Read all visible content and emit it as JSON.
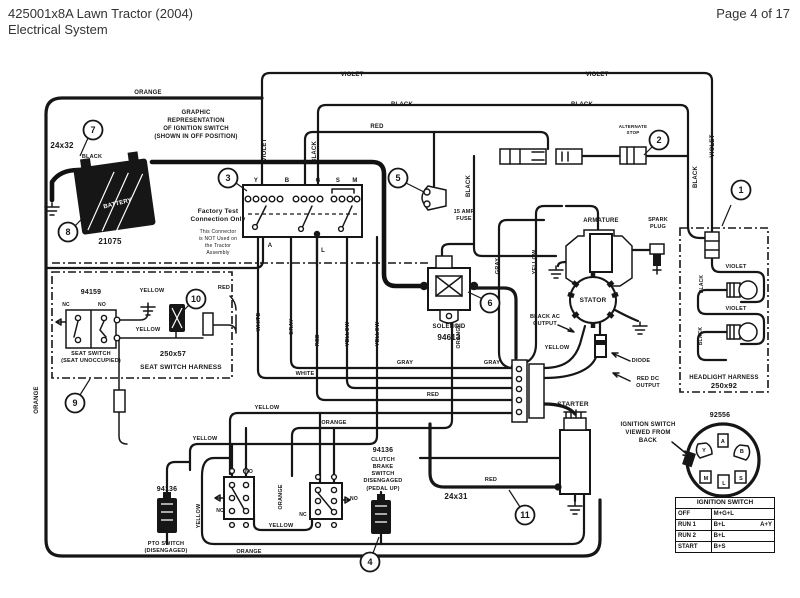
{
  "header": {
    "title_line1": "425001x8A Lawn Tractor (2004)",
    "title_line2": "Electrical System",
    "page_indicator": "Page 4 of 17"
  },
  "diagram": {
    "callouts": [
      {
        "n": "1",
        "x": 741,
        "y": 190,
        "lx": 731,
        "ly": 205,
        "tx": 722,
        "ty": 226
      },
      {
        "n": "2",
        "x": 659,
        "y": 140,
        "lx": 652,
        "ly": 147,
        "tx": 644,
        "ty": 155
      },
      {
        "n": "3",
        "x": 228,
        "y": 178,
        "lx": 236,
        "ly": 183,
        "tx": 247,
        "ty": 191
      },
      {
        "n": "4",
        "x": 370,
        "y": 562,
        "lx": 373,
        "ly": 553,
        "tx": 379,
        "ty": 537
      },
      {
        "n": "5",
        "x": 398,
        "y": 178,
        "lx": 406,
        "ly": 183,
        "tx": 424,
        "ty": 192
      },
      {
        "n": "6",
        "x": 490,
        "y": 303,
        "lx": 483,
        "ly": 299,
        "tx": 468,
        "ty": 292
      },
      {
        "n": "7",
        "x": 93,
        "y": 130,
        "lx": 88,
        "ly": 138,
        "tx": 80,
        "ty": 156
      },
      {
        "n": "8",
        "x": 68,
        "y": 232,
        "lx": 75,
        "ly": 226,
        "tx": 96,
        "ty": 204
      },
      {
        "n": "9",
        "x": 75,
        "y": 403,
        "lx": 80,
        "ly": 395,
        "tx": 90,
        "ty": 379
      },
      {
        "n": "10",
        "x": 196,
        "y": 299,
        "lx": 191,
        "ly": 303,
        "tx": 184,
        "ty": 310
      },
      {
        "n": "11",
        "x": 525,
        "y": 515,
        "lx": 520,
        "ly": 507,
        "tx": 509,
        "ty": 490
      }
    ],
    "labels": [
      {
        "name": "wire-violet-top-left",
        "text": "VIOLET",
        "x": 352,
        "y": 76
      },
      {
        "name": "wire-violet-top-right",
        "text": "VIOLET",
        "x": 597,
        "y": 76
      },
      {
        "name": "wire-black-top-left",
        "text": "BLACK",
        "x": 402,
        "y": 106
      },
      {
        "name": "wire-black-top-right",
        "text": "BLACK",
        "x": 582,
        "y": 106
      },
      {
        "name": "wire-orange-top",
        "text": "ORANGE",
        "x": 148,
        "y": 94
      },
      {
        "name": "wire-red-top",
        "text": "RED",
        "x": 377,
        "y": 128
      },
      {
        "name": "wire-violet-vert",
        "text": "VIOLET",
        "x": 266,
        "y": 150,
        "r": -90
      },
      {
        "name": "wire-black-vert-switch",
        "text": "BLACK",
        "x": 316,
        "y": 152,
        "r": -90
      },
      {
        "name": "wire-black-vert-fuse",
        "text": "BLACK",
        "x": 470,
        "y": 186,
        "r": -90
      },
      {
        "name": "wire-black-vert-head",
        "text": "BLACK",
        "x": 697,
        "y": 177,
        "r": -90
      },
      {
        "name": "wire-violet-vert-head",
        "text": "VIOLET",
        "x": 714,
        "y": 146,
        "r": -90
      },
      {
        "name": "wire-black-battery",
        "text": "BLACK",
        "x": 92,
        "y": 158,
        "s": 5.5
      },
      {
        "name": "wire-white-vert",
        "text": "WHITE",
        "x": 260,
        "y": 322,
        "r": -90,
        "s": 5.5
      },
      {
        "name": "wire-gray-vert",
        "text": "GRAY",
        "x": 293,
        "y": 327,
        "r": -90,
        "s": 5.5
      },
      {
        "name": "wire-red-vert",
        "text": "RED",
        "x": 319,
        "y": 340,
        "r": -90,
        "s": 5.5
      },
      {
        "name": "wire-yellow-vert-1",
        "text": "YELLOW",
        "x": 349,
        "y": 334,
        "r": -90,
        "s": 5.5
      },
      {
        "name": "wire-yellow-vert-2",
        "text": "YELLOW",
        "x": 379,
        "y": 334,
        "r": -90,
        "s": 5.5
      },
      {
        "name": "wire-gray-vert-sol",
        "text": "GRAY",
        "x": 499,
        "y": 266,
        "r": -90,
        "s": 5.5
      },
      {
        "name": "wire-yellow-vert-sol",
        "text": "YELLOW",
        "x": 536,
        "y": 262,
        "r": -90,
        "s": 5.5
      },
      {
        "name": "wire-orange-vert-sol",
        "text": "ORANGE",
        "x": 460,
        "y": 336,
        "r": -90,
        "s": 5.5
      },
      {
        "name": "wire-gray-row-1",
        "text": "GRAY",
        "x": 405,
        "y": 364,
        "s": 5.5
      },
      {
        "name": "wire-gray-row-2",
        "text": "GRAY",
        "x": 492,
        "y": 364,
        "s": 5.5
      },
      {
        "name": "wire-white-row",
        "text": "WHITE",
        "x": 305,
        "y": 375,
        "s": 5.5
      },
      {
        "name": "wire-red-row",
        "text": "RED",
        "x": 433,
        "y": 396,
        "s": 5.5
      },
      {
        "name": "wire-yellow-stator",
        "text": "YELLOW",
        "x": 557,
        "y": 349,
        "s": 5.5
      },
      {
        "name": "wire-orange-left",
        "text": "ORANGE",
        "x": 38,
        "y": 400,
        "r": -90
      },
      {
        "name": "wire-yellow-seat-1",
        "text": "YELLOW",
        "x": 152,
        "y": 292,
        "s": 5.5
      },
      {
        "name": "wire-yellow-seat-2",
        "text": "YELLOW",
        "x": 148,
        "y": 331,
        "s": 5.5
      },
      {
        "name": "wire-red-seat",
        "text": "RED",
        "x": 224,
        "y": 289,
        "s": 5.5
      },
      {
        "name": "wire-yellow-bottom-1",
        "text": "YELLOW",
        "x": 205,
        "y": 440,
        "s": 5.5
      },
      {
        "name": "wire-yellow-bottom-2",
        "text": "YELLOW",
        "x": 267,
        "y": 409,
        "s": 5.5
      },
      {
        "name": "wire-orange-bottom-1",
        "text": "ORANGE",
        "x": 334,
        "y": 424,
        "s": 5.5
      },
      {
        "name": "wire-yellow-bottom-3",
        "text": "YELLOW",
        "x": 281,
        "y": 527,
        "s": 5.5
      },
      {
        "name": "wire-orange-bottom-2",
        "text": "ORANGE",
        "x": 249,
        "y": 553,
        "s": 5.5
      },
      {
        "name": "wire-yellow-pto",
        "text": "YELLOW",
        "x": 200,
        "y": 516,
        "r": -90,
        "s": 5.5
      },
      {
        "name": "wire-orange-boxes",
        "text": "ORANGE",
        "x": 282,
        "y": 497,
        "r": -90,
        "s": 5.5
      },
      {
        "name": "wire-red-starter",
        "text": "RED",
        "x": 491,
        "y": 481,
        "s": 5.5
      },
      {
        "name": "wire-violet-bulb-1",
        "text": "VIOLET",
        "x": 736,
        "y": 268,
        "s": 5.5
      },
      {
        "name": "wire-violet-bulb-2",
        "text": "VIOLET",
        "x": 736,
        "y": 310,
        "s": 5.5
      },
      {
        "name": "wire-black-bulb-1",
        "text": "BLACK",
        "x": 703,
        "y": 284,
        "r": -90,
        "s": 5
      },
      {
        "name": "wire-black-bulb-2",
        "text": "BLACK",
        "x": 702,
        "y": 336,
        "r": -90,
        "s": 5
      },
      {
        "name": "cable-24x32",
        "text": "24x32",
        "x": 62,
        "y": 148,
        "s": 8
      },
      {
        "name": "battery-number",
        "text": "21075",
        "x": 110,
        "y": 244,
        "s": 8
      },
      {
        "name": "battery-text",
        "text": "BATTERY",
        "x": 118,
        "y": 205,
        "s": 6,
        "r": -14,
        "c": "#fff"
      },
      {
        "name": "solenoid-label",
        "text": "SOLENOID",
        "x": 449,
        "y": 328,
        "s": 6
      },
      {
        "name": "solenoid-number",
        "text": "94613",
        "x": 449,
        "y": 340,
        "s": 8
      },
      {
        "name": "armature-label",
        "text": "ARMATURE",
        "x": 601,
        "y": 222,
        "s": 6
      },
      {
        "name": "spark-plug-label-1",
        "text": "SPARK",
        "x": 658,
        "y": 221,
        "s": 5.5
      },
      {
        "name": "spark-plug-label-2",
        "text": "PLUG",
        "x": 658,
        "y": 228,
        "s": 5.5
      },
      {
        "name": "stator-label",
        "text": "STATOR",
        "x": 593,
        "y": 302,
        "s": 6.5
      },
      {
        "name": "black-ac-output-1",
        "text": "BLACK AC",
        "x": 545,
        "y": 318,
        "s": 5.5
      },
      {
        "name": "black-ac-output-2",
        "text": "OUTPUT",
        "x": 545,
        "y": 325,
        "s": 5.5
      },
      {
        "name": "diode-label",
        "text": "DIODE",
        "x": 641,
        "y": 362,
        "s": 5.5
      },
      {
        "name": "red-dc-output-1",
        "text": "RED DC",
        "x": 648,
        "y": 380,
        "s": 5.5
      },
      {
        "name": "red-dc-output-2",
        "text": "OUTPUT",
        "x": 648,
        "y": 387,
        "s": 5.5
      },
      {
        "name": "starter-label",
        "text": "STARTER",
        "x": 573,
        "y": 406,
        "s": 6.5
      },
      {
        "name": "cable-24x31",
        "text": "24x31",
        "x": 456,
        "y": 499,
        "s": 8
      },
      {
        "name": "headlight-harness-label",
        "text": "HEADLIGHT HARNESS",
        "x": 724,
        "y": 379,
        "s": 6
      },
      {
        "name": "headlight-harness-number",
        "text": "250x92",
        "x": 724,
        "y": 388,
        "s": 7.5
      },
      {
        "name": "back-connector-number",
        "text": "92556",
        "x": 720,
        "y": 417,
        "s": 7
      },
      {
        "name": "viewed-from-back-1",
        "text": "IGNITION SWITCH",
        "x": 648,
        "y": 426,
        "s": 6
      },
      {
        "name": "viewed-from-back-2",
        "text": "VIEWED FROM",
        "x": 648,
        "y": 434,
        "s": 6
      },
      {
        "name": "viewed-from-back-3",
        "text": "BACK",
        "x": 648,
        "y": 442,
        "s": 6
      },
      {
        "name": "seat-switch-number",
        "text": "94159",
        "x": 91,
        "y": 294,
        "s": 7
      },
      {
        "name": "seat-switch-nc",
        "text": "NC",
        "x": 66,
        "y": 306,
        "s": 5
      },
      {
        "name": "seat-switch-no",
        "text": "NO",
        "x": 102,
        "y": 306,
        "s": 5
      },
      {
        "name": "seat-switch-label-1",
        "text": "SEAT SWITCH",
        "x": 91,
        "y": 355,
        "s": 5.5
      },
      {
        "name": "seat-switch-label-2",
        "text": "(SEAT UNOCCUPIED)",
        "x": 91,
        "y": 362,
        "s": 5.5
      },
      {
        "name": "seat-harness-number",
        "text": "250x57",
        "x": 173,
        "y": 356,
        "s": 7.5
      },
      {
        "name": "seat-harness-label",
        "text": "SEAT SWITCH HARNESS",
        "x": 181,
        "y": 369,
        "s": 6.5
      },
      {
        "name": "pto-switch-number",
        "text": "94136",
        "x": 167,
        "y": 491,
        "s": 7
      },
      {
        "name": "pto-switch-label-1",
        "text": "PTO SWITCH",
        "x": 166,
        "y": 545,
        "s": 5.5
      },
      {
        "name": "pto-switch-label-2",
        "text": "(DISENGAGED)",
        "x": 166,
        "y": 552,
        "s": 5.5
      },
      {
        "name": "clutch-switch-number",
        "text": "94136",
        "x": 383,
        "y": 452,
        "s": 7
      },
      {
        "name": "clutch-switch-label-1",
        "text": "CLUTCH",
        "x": 383,
        "y": 461,
        "s": 5.5
      },
      {
        "name": "clutch-switch-label-2",
        "text": "BRAKE",
        "x": 383,
        "y": 468,
        "s": 5.5
      },
      {
        "name": "clutch-switch-label-3",
        "text": "SWITCH",
        "x": 383,
        "y": 475,
        "s": 5.5
      },
      {
        "name": "clutch-switch-label-4",
        "text": "DISENGAGED",
        "x": 383,
        "y": 482,
        "s": 5.5
      },
      {
        "name": "clutch-switch-label-5",
        "text": "(PEDAL UP)",
        "x": 383,
        "y": 490,
        "s": 5.5
      },
      {
        "name": "box1-no",
        "text": "NO",
        "x": 249,
        "y": 473,
        "s": 5
      },
      {
        "name": "box1-nc",
        "text": "NC",
        "x": 220,
        "y": 512,
        "s": 5
      },
      {
        "name": "box2-nc",
        "text": "NC",
        "x": 303,
        "y": 516,
        "s": 5
      },
      {
        "name": "box2-no",
        "text": "NO",
        "x": 354,
        "y": 500,
        "s": 5
      },
      {
        "name": "graphic-rep-1",
        "text": "GRAPHIC",
        "x": 196,
        "y": 114,
        "s": 6
      },
      {
        "name": "graphic-rep-2",
        "text": "REPRESENTATION",
        "x": 196,
        "y": 122,
        "s": 6
      },
      {
        "name": "graphic-rep-3",
        "text": "OF IGNITION SWITCH",
        "x": 196,
        "y": 130,
        "s": 6
      },
      {
        "name": "graphic-rep-4",
        "text": "(SHOWN IN OFF POSITION)",
        "x": 196,
        "y": 138,
        "s": 6
      },
      {
        "name": "factory-test-1",
        "text": "Factory Test",
        "x": 218,
        "y": 213,
        "s": 6.5
      },
      {
        "name": "factory-test-2",
        "text": "Connection Only",
        "x": 218,
        "y": 221,
        "s": 6.5
      },
      {
        "name": "factory-note-1",
        "text": "This Connector",
        "x": 218,
        "y": 233,
        "s": 5,
        "b": 0
      },
      {
        "name": "factory-note-2",
        "text": "is NOT Used on",
        "x": 218,
        "y": 240,
        "s": 5,
        "b": 0
      },
      {
        "name": "factory-note-3",
        "text": "the Tractor",
        "x": 218,
        "y": 247,
        "s": 5,
        "b": 0
      },
      {
        "name": "factory-note-4",
        "text": "Assembly",
        "x": 218,
        "y": 254,
        "s": 5,
        "b": 0
      },
      {
        "name": "fuse-label-1",
        "text": "15 AMP",
        "x": 464,
        "y": 213,
        "s": 5.5
      },
      {
        "name": "fuse-label-2",
        "text": "FUSE",
        "x": 464,
        "y": 220,
        "s": 5.5
      },
      {
        "name": "terminal-y",
        "text": "Y",
        "x": 256,
        "y": 182,
        "s": 6
      },
      {
        "name": "terminal-b",
        "text": "B",
        "x": 287,
        "y": 182,
        "s": 6
      },
      {
        "name": "terminal-g",
        "text": "G",
        "x": 318,
        "y": 182,
        "s": 6
      },
      {
        "name": "terminal-s",
        "text": "S",
        "x": 338,
        "y": 182,
        "s": 6
      },
      {
        "name": "terminal-m",
        "text": "M",
        "x": 355,
        "y": 182,
        "s": 6
      },
      {
        "name": "terminal-a",
        "text": "A",
        "x": 270,
        "y": 247,
        "s": 6
      },
      {
        "name": "terminal-l",
        "text": "L",
        "x": 323,
        "y": 252,
        "s": 6
      },
      {
        "name": "back-terminal-a",
        "text": "A",
        "x": 723,
        "y": 443,
        "s": 5.5
      },
      {
        "name": "back-terminal-y",
        "text": "Y",
        "x": 704,
        "y": 452,
        "s": 5.5
      },
      {
        "name": "back-terminal-b",
        "text": "B",
        "x": 742,
        "y": 453,
        "s": 5.5
      },
      {
        "name": "back-terminal-m",
        "text": "M",
        "x": 706,
        "y": 480,
        "s": 5.5
      },
      {
        "name": "back-terminal-l",
        "text": "L",
        "x": 724,
        "y": 485,
        "s": 5.5
      },
      {
        "name": "back-terminal-s",
        "text": "S",
        "x": 741,
        "y": 480,
        "s": 5.5
      },
      {
        "name": "alternate-stop-1",
        "text": "ALTERNATE",
        "x": 633,
        "y": 128,
        "s": 4.5
      },
      {
        "name": "alternate-stop-2",
        "text": "STOP",
        "x": 633,
        "y": 134,
        "s": 4.5
      }
    ],
    "truth_table": {
      "title": "IGNITION SWITCH",
      "rows": [
        {
          "pos": "OFF",
          "circuits": "M+G+L",
          "extra": ""
        },
        {
          "pos": "RUN 1",
          "circuits": "B+L",
          "extra": "A+Y"
        },
        {
          "pos": "RUN 2",
          "circuits": "B+L",
          "extra": ""
        },
        {
          "pos": "START",
          "circuits": "B+S",
          "extra": ""
        }
      ]
    }
  }
}
